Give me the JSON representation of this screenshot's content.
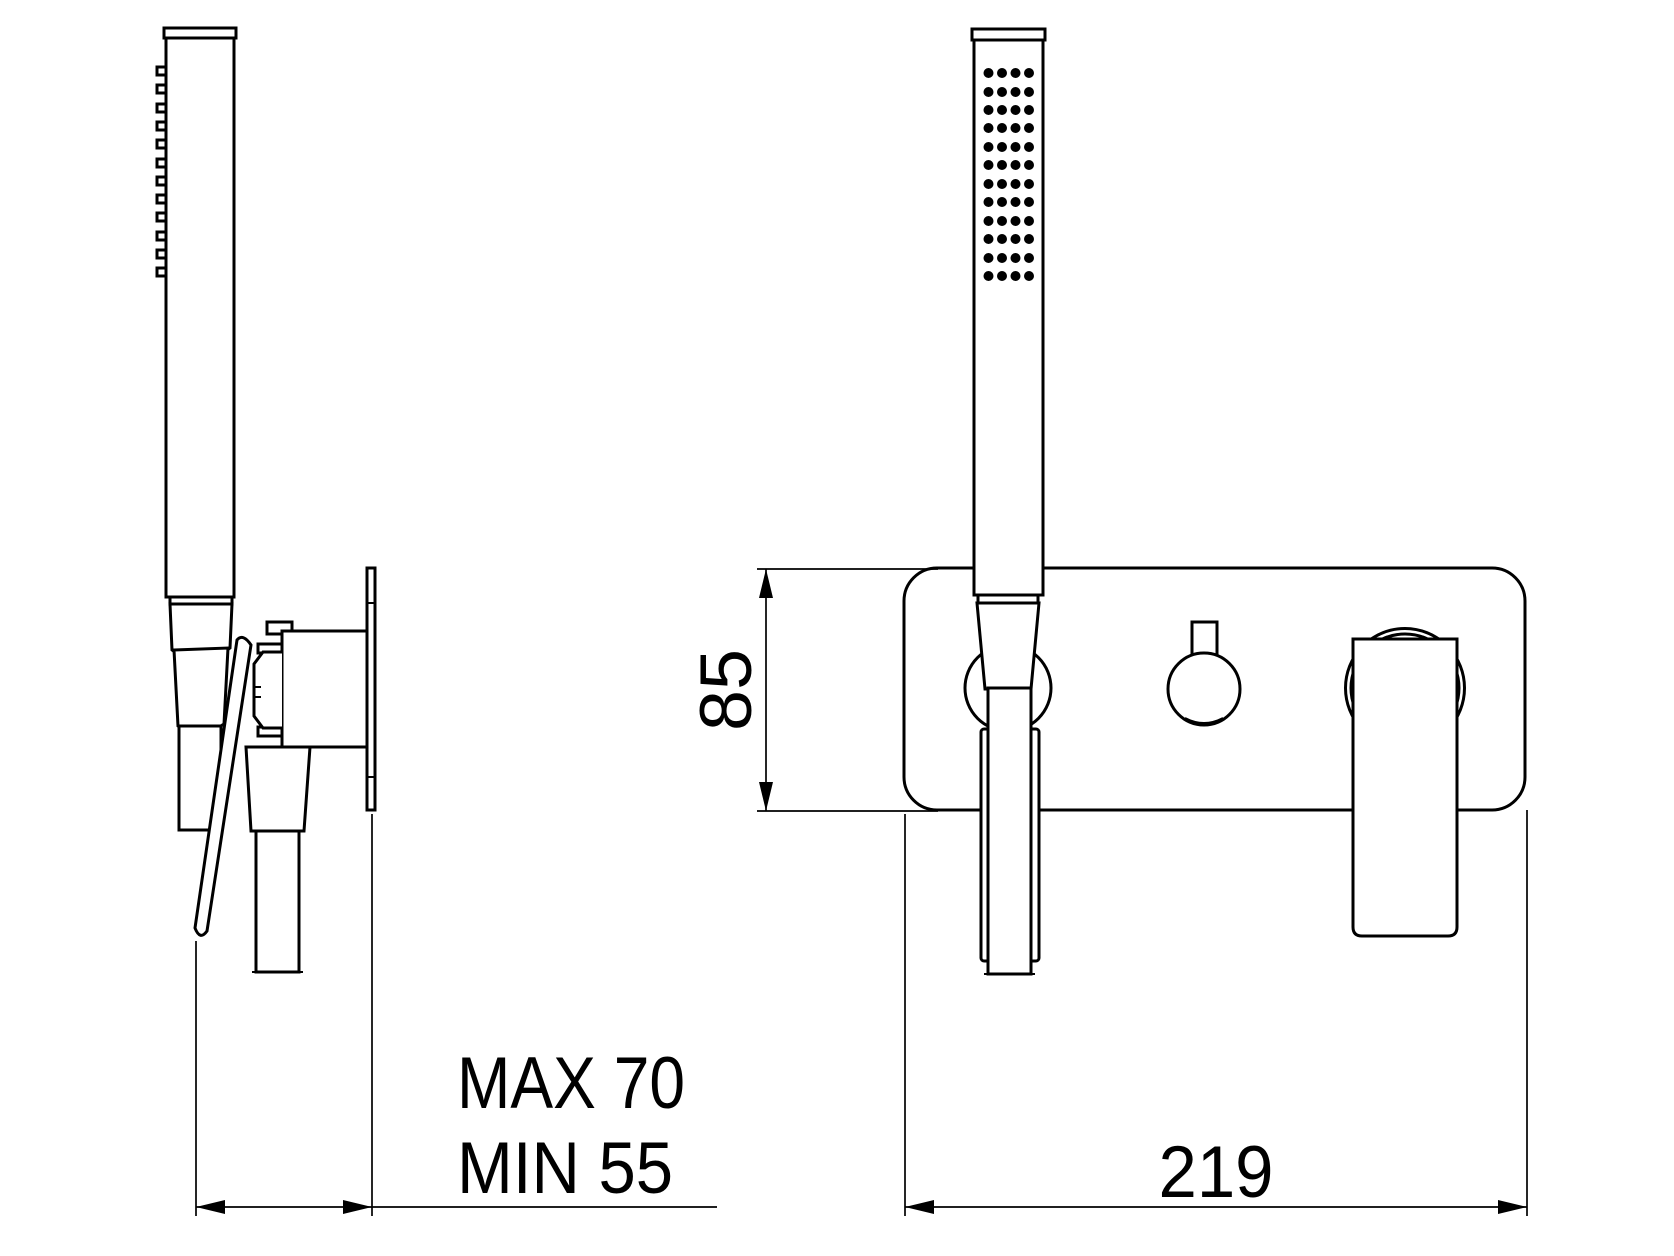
{
  "page": {
    "background_color": "#ffffff",
    "line_color": "#000000"
  },
  "labels": {
    "depth_max": "MAX 70",
    "depth_min": "MIN 55",
    "plate_height": "85",
    "plate_width": "219"
  }
}
